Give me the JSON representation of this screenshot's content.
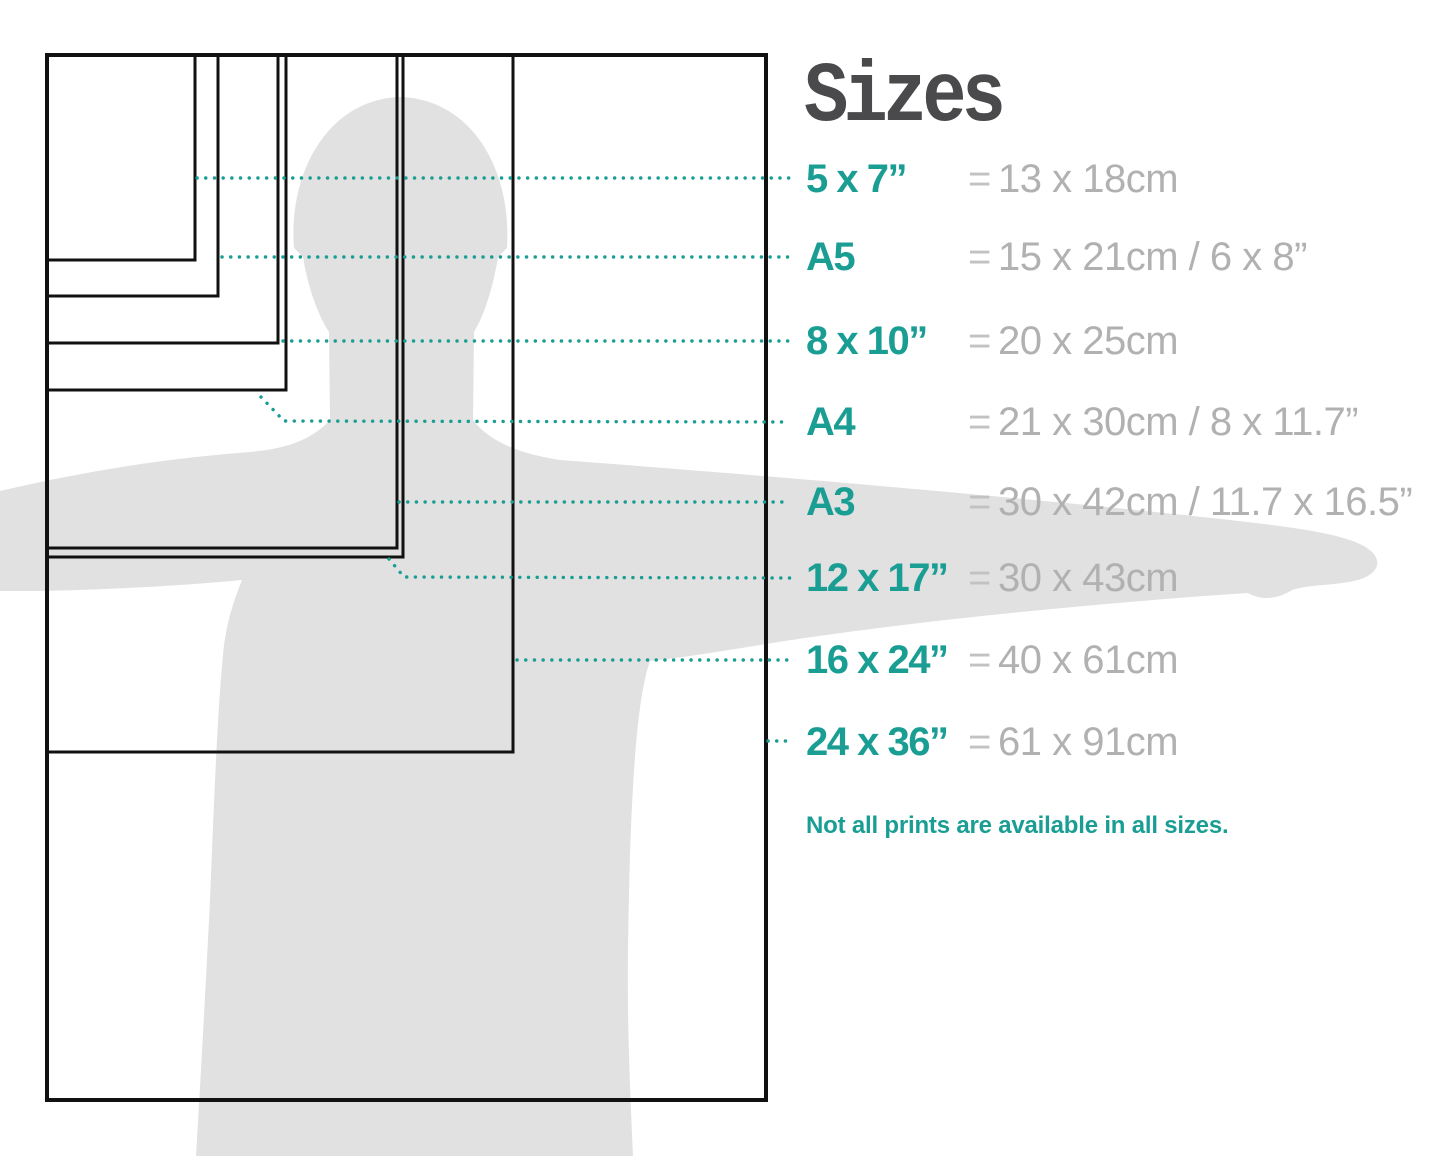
{
  "title": "Sizes",
  "note": "Not all prints are available in all sizes.",
  "equals_sign": "=",
  "colors": {
    "accent_teal": "#1a9e94",
    "metric_gray": "#b1b1b1",
    "title_gray": "#4a4a4d",
    "silhouette_gray": "#e1e1e1",
    "outline_black": "#111111"
  },
  "sizes": [
    {
      "label": "5 x 7”",
      "metric": "13 x 18cm"
    },
    {
      "label": "A5",
      "metric": "15 x 21cm / 6 x 8”"
    },
    {
      "label": "8 x 10”",
      "metric": "20 x 25cm"
    },
    {
      "label": "A4",
      "metric": "21 x 30cm / 8 x 11.7”"
    },
    {
      "label": "A3",
      "metric": "30 x 42cm / 11.7 x 16.5”"
    },
    {
      "label": "12 x 17”",
      "metric": "30 x 43cm"
    },
    {
      "label": "16 x 24”",
      "metric": "40 x 61cm"
    },
    {
      "label": "24 x 36”",
      "metric": "61 x 91cm"
    }
  ],
  "chart_data": {
    "type": "diagram",
    "title": "Sizes",
    "description": "Nested print-size rectangles over a human silhouette for scale",
    "sizes_inches": [
      "5 x 7",
      "A5",
      "8 x 10",
      "A4",
      "A3",
      "12 x 17",
      "16 x 24",
      "24 x 36"
    ],
    "sizes_cm": [
      "13 x 18",
      "15 x 21",
      "20 x 25",
      "21 x 30",
      "30 x 42",
      "30 x 43",
      "40 x 61",
      "61 x 91"
    ]
  }
}
